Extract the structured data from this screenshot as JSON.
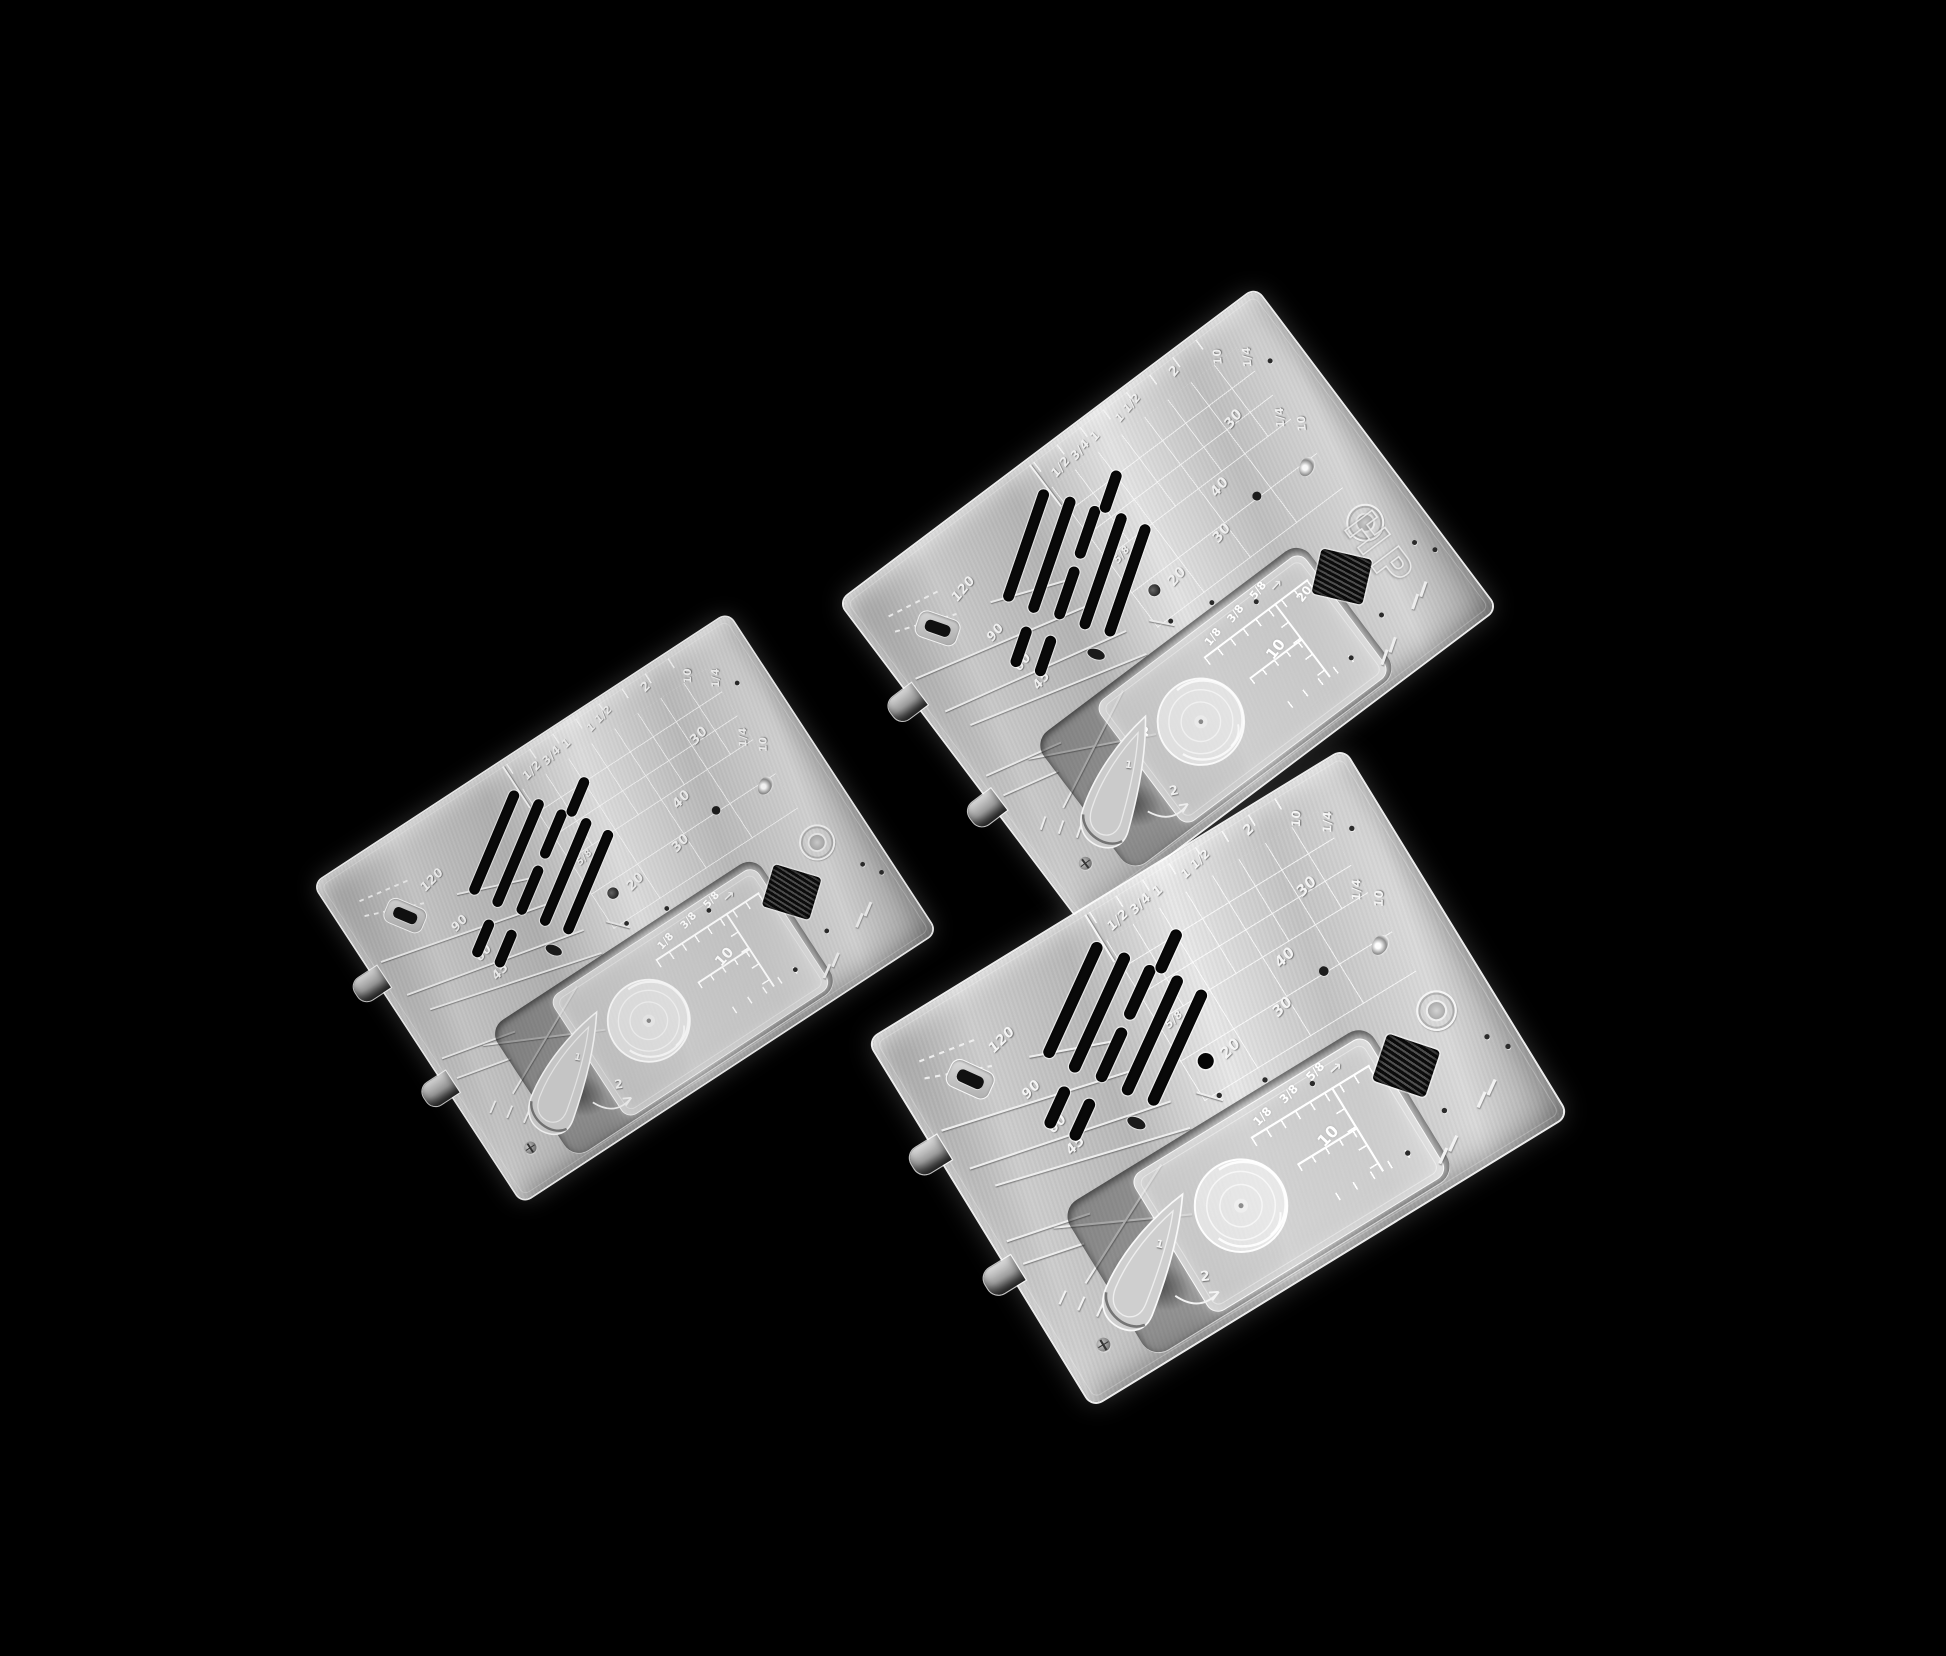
{
  "scene": {
    "background_color": "#000000"
  },
  "plates": [
    {
      "name": "needle-plate-standard-left",
      "badge": "",
      "top_ruler": {
        "f12": "1/2",
        "f34": "3/4",
        "f1": "1",
        "f112": "1 1/2",
        "f2": "2"
      },
      "edge_labels": {
        "ten": "10",
        "quarter": "1/4"
      },
      "side_labels": {
        "quarter": "1/4",
        "ten": "10"
      },
      "grid_labels": {
        "g58": "5/8",
        "g20": "20",
        "g30a": "30",
        "g40": "40",
        "g30b": "30"
      },
      "angle_labels": {
        "a120": "120",
        "a90": "90",
        "a60": "60",
        "a45": "45"
      },
      "cover": {
        "brand": "",
        "f18": "1/8",
        "f38": "3/8",
        "f58": "5/8",
        "ten": "10",
        "twenty": ""
      },
      "lever": {
        "one": "1",
        "two": "2"
      },
      "arrow_icon": "→"
    },
    {
      "name": "needle-plate-hp-top-right",
      "badge": "HP",
      "top_ruler": {
        "f12": "1/2",
        "f34": "3/4",
        "f1": "1",
        "f112": "1 1/2",
        "f2": "2"
      },
      "edge_labels": {
        "ten": "10",
        "quarter": "1/4"
      },
      "side_labels": {
        "quarter": "1/4",
        "ten": "10"
      },
      "grid_labels": {
        "g58": "5/8",
        "g20": "20",
        "g30a": "30",
        "g40": "40",
        "g30b": "30"
      },
      "angle_labels": {
        "a120": "120",
        "a90": "90",
        "a60": "60",
        "a45": "45"
      },
      "cover": {
        "brand": "HP",
        "f18": "1/8",
        "f38": "3/8",
        "f58": "5/8",
        "ten": "10",
        "twenty": "20"
      },
      "lever": {
        "one": "1",
        "two": "2"
      },
      "arrow_icon": "→"
    },
    {
      "name": "needle-plate-standard-bottom-right",
      "badge": "",
      "top_ruler": {
        "f12": "1/2",
        "f34": "3/4",
        "f1": "1",
        "f112": "1 1/2",
        "f2": "2"
      },
      "edge_labels": {
        "ten": "10",
        "quarter": "1/4"
      },
      "side_labels": {
        "quarter": "1/4",
        "ten": "10"
      },
      "grid_labels": {
        "g58": "5/8",
        "g20": "20",
        "g30a": "30",
        "g40": "40",
        "g30b": "30"
      },
      "angle_labels": {
        "a120": "120",
        "a90": "90",
        "a60": "60",
        "a45": "45"
      },
      "cover": {
        "brand": "",
        "f18": "1/8",
        "f38": "3/8",
        "f58": "5/8",
        "ten": "10",
        "twenty": ""
      },
      "lever": {
        "one": "1",
        "two": "2"
      },
      "arrow_icon": "→"
    }
  ]
}
